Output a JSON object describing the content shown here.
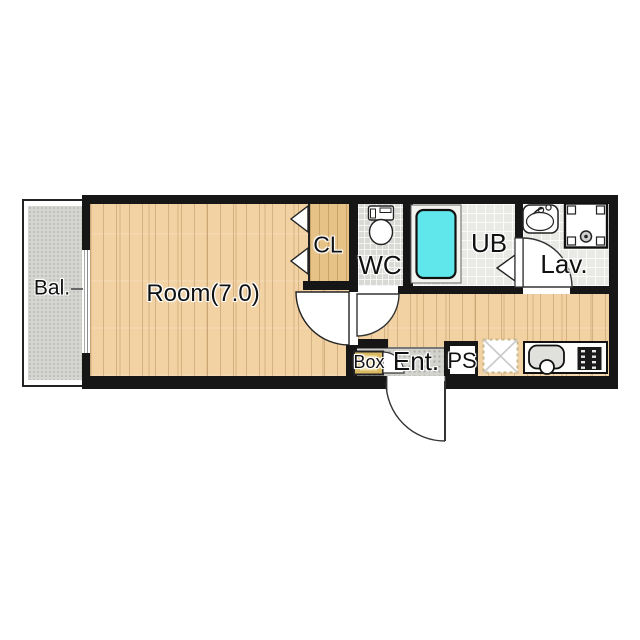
{
  "plan": {
    "rooms": {
      "balcony": {
        "label": "Bal."
      },
      "main_room": {
        "label": "Room(7.0)"
      },
      "closet": {
        "label": "CL"
      },
      "toilet": {
        "label": "WC"
      },
      "unit_bath": {
        "label": "UB"
      },
      "lavatory": {
        "label": "Lav."
      },
      "shoe_box": {
        "label": "Box"
      },
      "entrance": {
        "label": "Ent."
      },
      "pipe_space": {
        "label": "PS"
      }
    },
    "fixtures": [
      "toilet-icon",
      "bathtub-icon",
      "washbasin-icon",
      "washing-machine-space-icon",
      "kitchen-sink-icon",
      "stove-icon",
      "refrigerator-space-icon",
      "sliding-window-icon",
      "entrance-door-icon",
      "room-door-icon",
      "toilet-door-icon",
      "lavatory-door-icon",
      "bath-door-icon",
      "closet-bifold-door-icon",
      "shoebox-door-icon"
    ],
    "colors": {
      "wall": "#161616",
      "wood_floor": "#f2d2a2",
      "closet_floor": "#e6c286",
      "toilet_floor": "#d9d9d5",
      "bath_floor": "#e9e9e5",
      "entrance_floor": "#d3d3ce",
      "balcony_floor": "#d5d5d1",
      "bathtub": "#5fe7eb",
      "shoe_box": "#d9ba62"
    }
  }
}
